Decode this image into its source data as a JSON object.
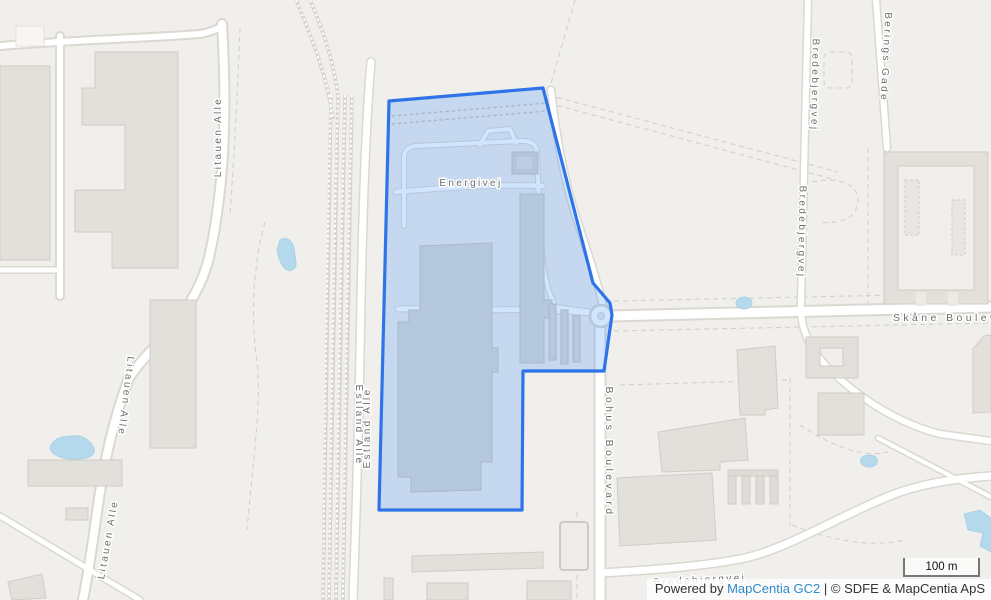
{
  "map": {
    "labels": {
      "litauen_alle_north": "Litauen Alle",
      "litauen_alle_mid": "Litauen Alle",
      "litauen_alle_south": "Litauen Alle",
      "estland_alle_west": "Estland Alle",
      "estland_alle_east": "Estland Alle",
      "energivej": "Energivej",
      "bohus_boulevard": "Bohus Boulevard",
      "skane_boulevard": "Skåne Boulevard",
      "bredebjergvej_north": "Bredebjergvej",
      "bredebjergvej_mid": "Bredebjergvej",
      "bredebjergvej_south": "Bredebjergvej",
      "berings_gade": "Berings Gade"
    },
    "colors": {
      "background": "#f0efeb",
      "selection_stroke": "#2e74e8",
      "selection_fill": "#3388ff",
      "water": "#b4d9ec",
      "attribution_link": "#2d8ac9"
    }
  },
  "scalebar": {
    "label": "100 m"
  },
  "attribution": {
    "prefix": "Powered by ",
    "link_label": "MapCentia GC2",
    "separator": " | ",
    "copyright": "© SDFE & MapCentia ApS"
  }
}
